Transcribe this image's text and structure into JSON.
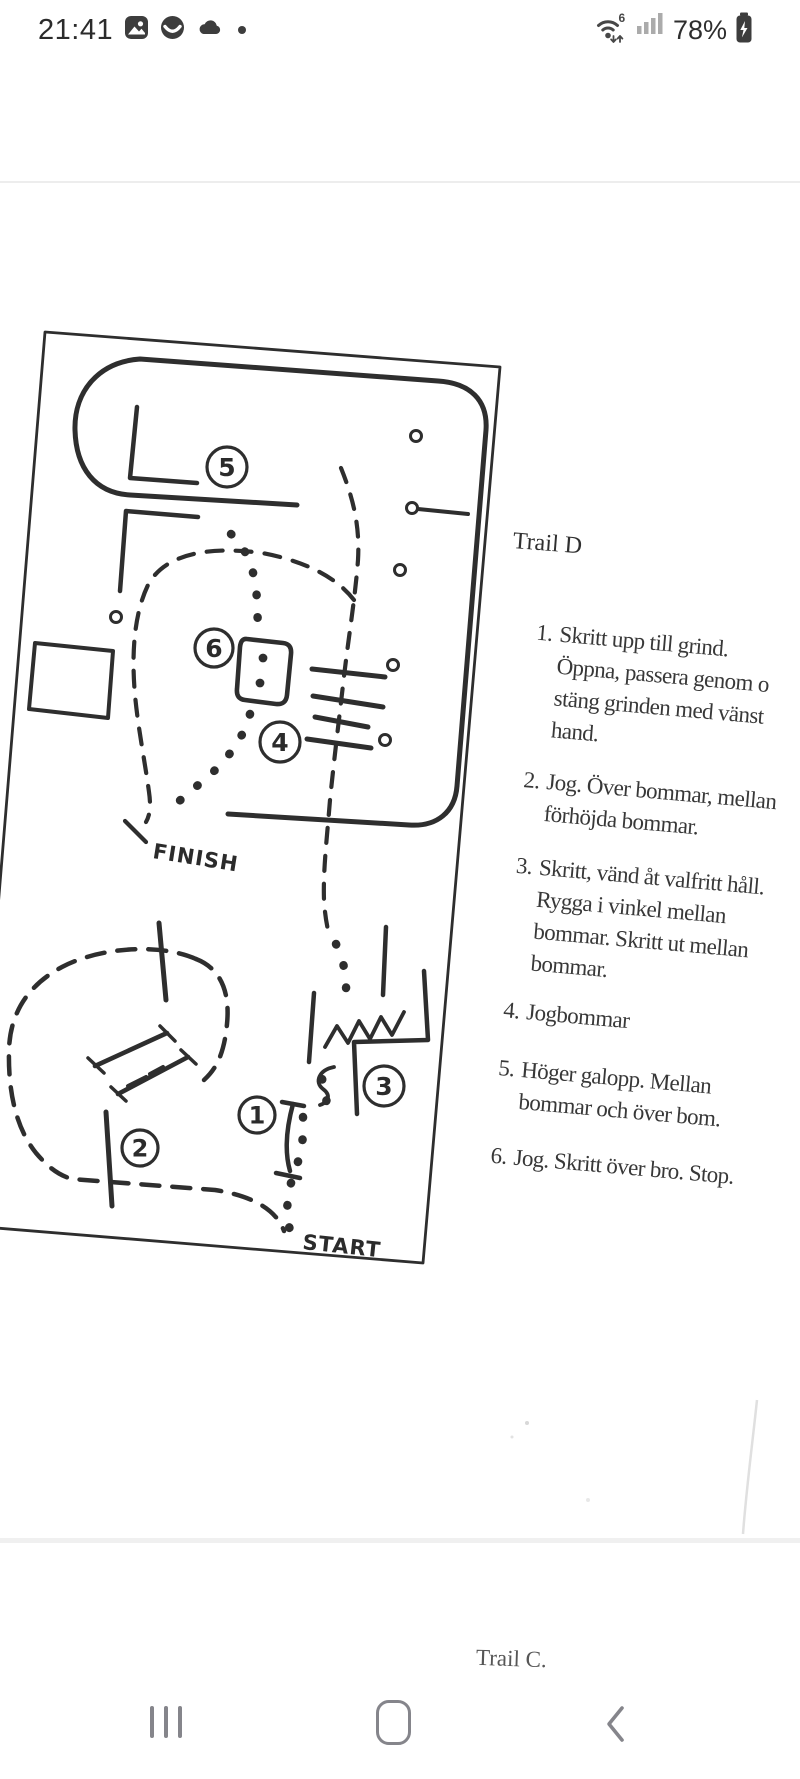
{
  "status_bar": {
    "time": "21:41",
    "wifi_generation": "6",
    "battery_percent": "78%",
    "notification_icons": [
      "gallery-icon",
      "smiley-icon",
      "cloud-icon",
      "more-notifications-dot"
    ]
  },
  "photo_page": {
    "trail_title": "Trail D",
    "instructions": [
      {
        "num": "1.",
        "lines": [
          "Skritt upp till grind.",
          "Öppna, passera genom o",
          "stäng grinden med vänst",
          "hand."
        ]
      },
      {
        "num": "2.",
        "lines": [
          "Jog. Över bommar, mellan",
          "förhöjda bommar."
        ]
      },
      {
        "num": "3.",
        "lines": [
          "Skritt, vänd åt valfritt håll.",
          "Rygga i vinkel mellan",
          "bommar. Skritt ut mellan",
          "bommar."
        ]
      },
      {
        "num": "4.",
        "lines": [
          "Jogbommar"
        ]
      },
      {
        "num": "5.",
        "lines": [
          "Höger galopp. Mellan",
          "bommar och över bom."
        ]
      },
      {
        "num": "6.",
        "lines": [
          "Jog. Skritt över bro. Stop."
        ]
      }
    ],
    "map_labels": {
      "finish": "FINISH",
      "start": "START",
      "markers": {
        "m1": "1",
        "m2": "2",
        "m3": "3",
        "m4": "4",
        "m5": "5",
        "m6": "6"
      }
    },
    "next_page_title": "Trail C.",
    "ink_color": "#2e2e2e"
  },
  "nav_bar": {
    "icons": [
      "recents-icon",
      "home-icon",
      "back-icon"
    ]
  }
}
